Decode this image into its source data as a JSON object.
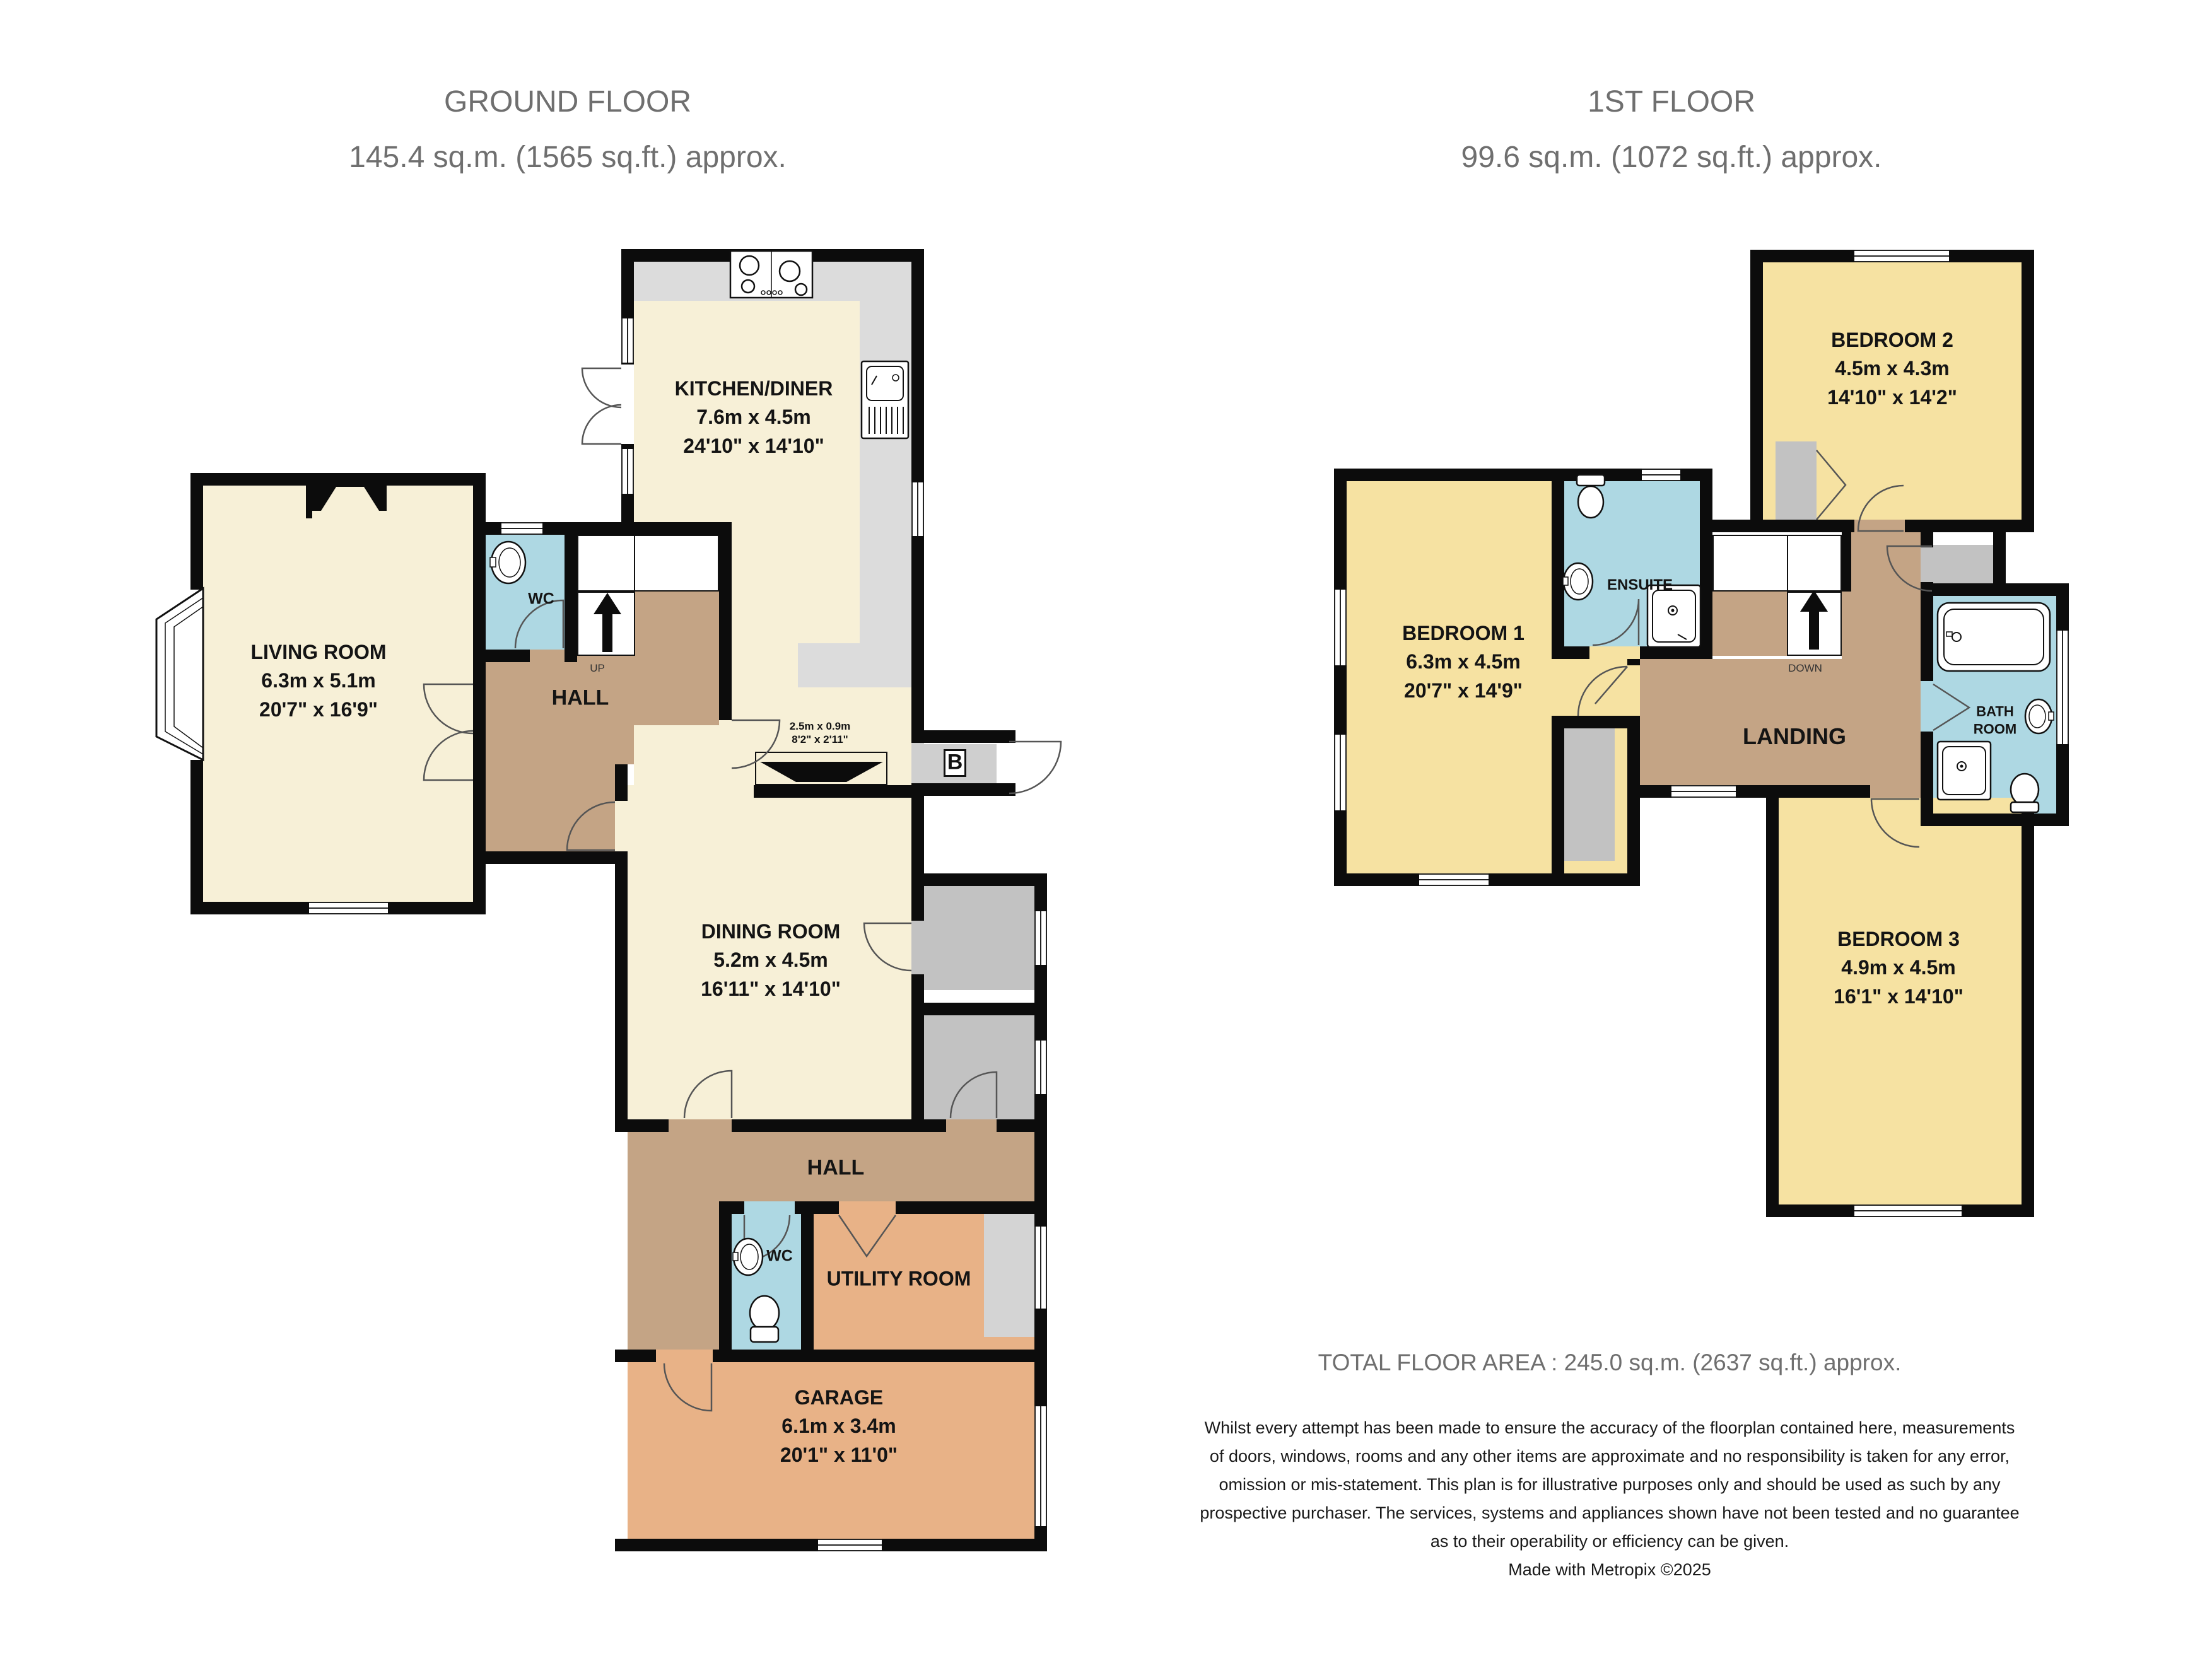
{
  "titles": {
    "ground": "GROUND FLOOR\n145.4 sq.m. (1565 sq.ft.) approx.",
    "first": "1ST FLOOR\n99.6 sq.m. (1072 sq.ft.) approx."
  },
  "ground_floor": {
    "kitchen": {
      "name": "KITCHEN/DINER",
      "metric": "7.6m  x 4.5m",
      "imperial": "24'10\"  x 14'10\""
    },
    "living": {
      "name": "LIVING ROOM",
      "metric": "6.3m  x 5.1m",
      "imperial": "20'7\"  x 16'9\""
    },
    "dining": {
      "name": "DINING ROOM",
      "metric": "5.2m  x 4.5m",
      "imperial": "16'11\"  x 14'10\""
    },
    "garage": {
      "name": "GARAGE",
      "metric": "6.1m  x 3.4m",
      "imperial": "20'1\"  x 11'0\""
    },
    "utility": {
      "name": "UTILITY ROOM"
    },
    "hall_upper": {
      "name": "HALL"
    },
    "hall_lower": {
      "name": "HALL"
    },
    "wc_upper": {
      "name": "WC"
    },
    "wc_lower": {
      "name": "WC"
    },
    "stairs": {
      "label": "UP"
    },
    "fireplace": {
      "metric": "2.5m  x 0.9m",
      "imperial": "8'2\"  x 2'11\""
    },
    "porch": {
      "label": "B"
    }
  },
  "first_floor": {
    "bedroom1": {
      "name": "BEDROOM 1",
      "metric": "6.3m  x 4.5m",
      "imperial": "20'7\"  x 14'9\""
    },
    "bedroom2": {
      "name": "BEDROOM 2",
      "metric": "4.5m  x 4.3m",
      "imperial": "14'10\"  x 14'2\""
    },
    "bedroom3": {
      "name": "BEDROOM 3",
      "metric": "4.9m  x 4.5m",
      "imperial": "16'1\"  x 14'10\""
    },
    "ensuite": {
      "name": "ENSUITE"
    },
    "bathroom": {
      "name": "BATH\nROOM"
    },
    "landing": {
      "name": "LANDING"
    },
    "stairs": {
      "label": "DOWN"
    }
  },
  "footer": {
    "total": "TOTAL FLOOR AREA : 245.0 sq.m. (2637 sq.ft.) approx.",
    "disclaimer_lines": [
      "Whilst every attempt has been made to ensure the accuracy of the floorplan contained here, measurements",
      "of doors, windows, rooms and any other items are approximate and no responsibility is taken for any error,",
      "omission or mis-statement. This plan is for illustrative purposes only and should be used as such by any",
      "prospective purchaser. The services, systems and appliances shown have not been tested and no guarantee",
      "as to their operability or efficiency can be given."
    ],
    "credit": "Made with Metropix ©2025"
  },
  "colors": {
    "wall": "#0c0c0c",
    "cream": "#f7f0d7",
    "bedroom_yellow": "#f6e2a2",
    "hall_tan": "#c4a485",
    "bath_blue": "#aed8e3",
    "garage_peach": "#e8b287",
    "closet_gray": "#c2c2c2",
    "counter_gray": "#dcdcdc",
    "title_gray": "#6f6f6f",
    "arc": "#555555"
  }
}
